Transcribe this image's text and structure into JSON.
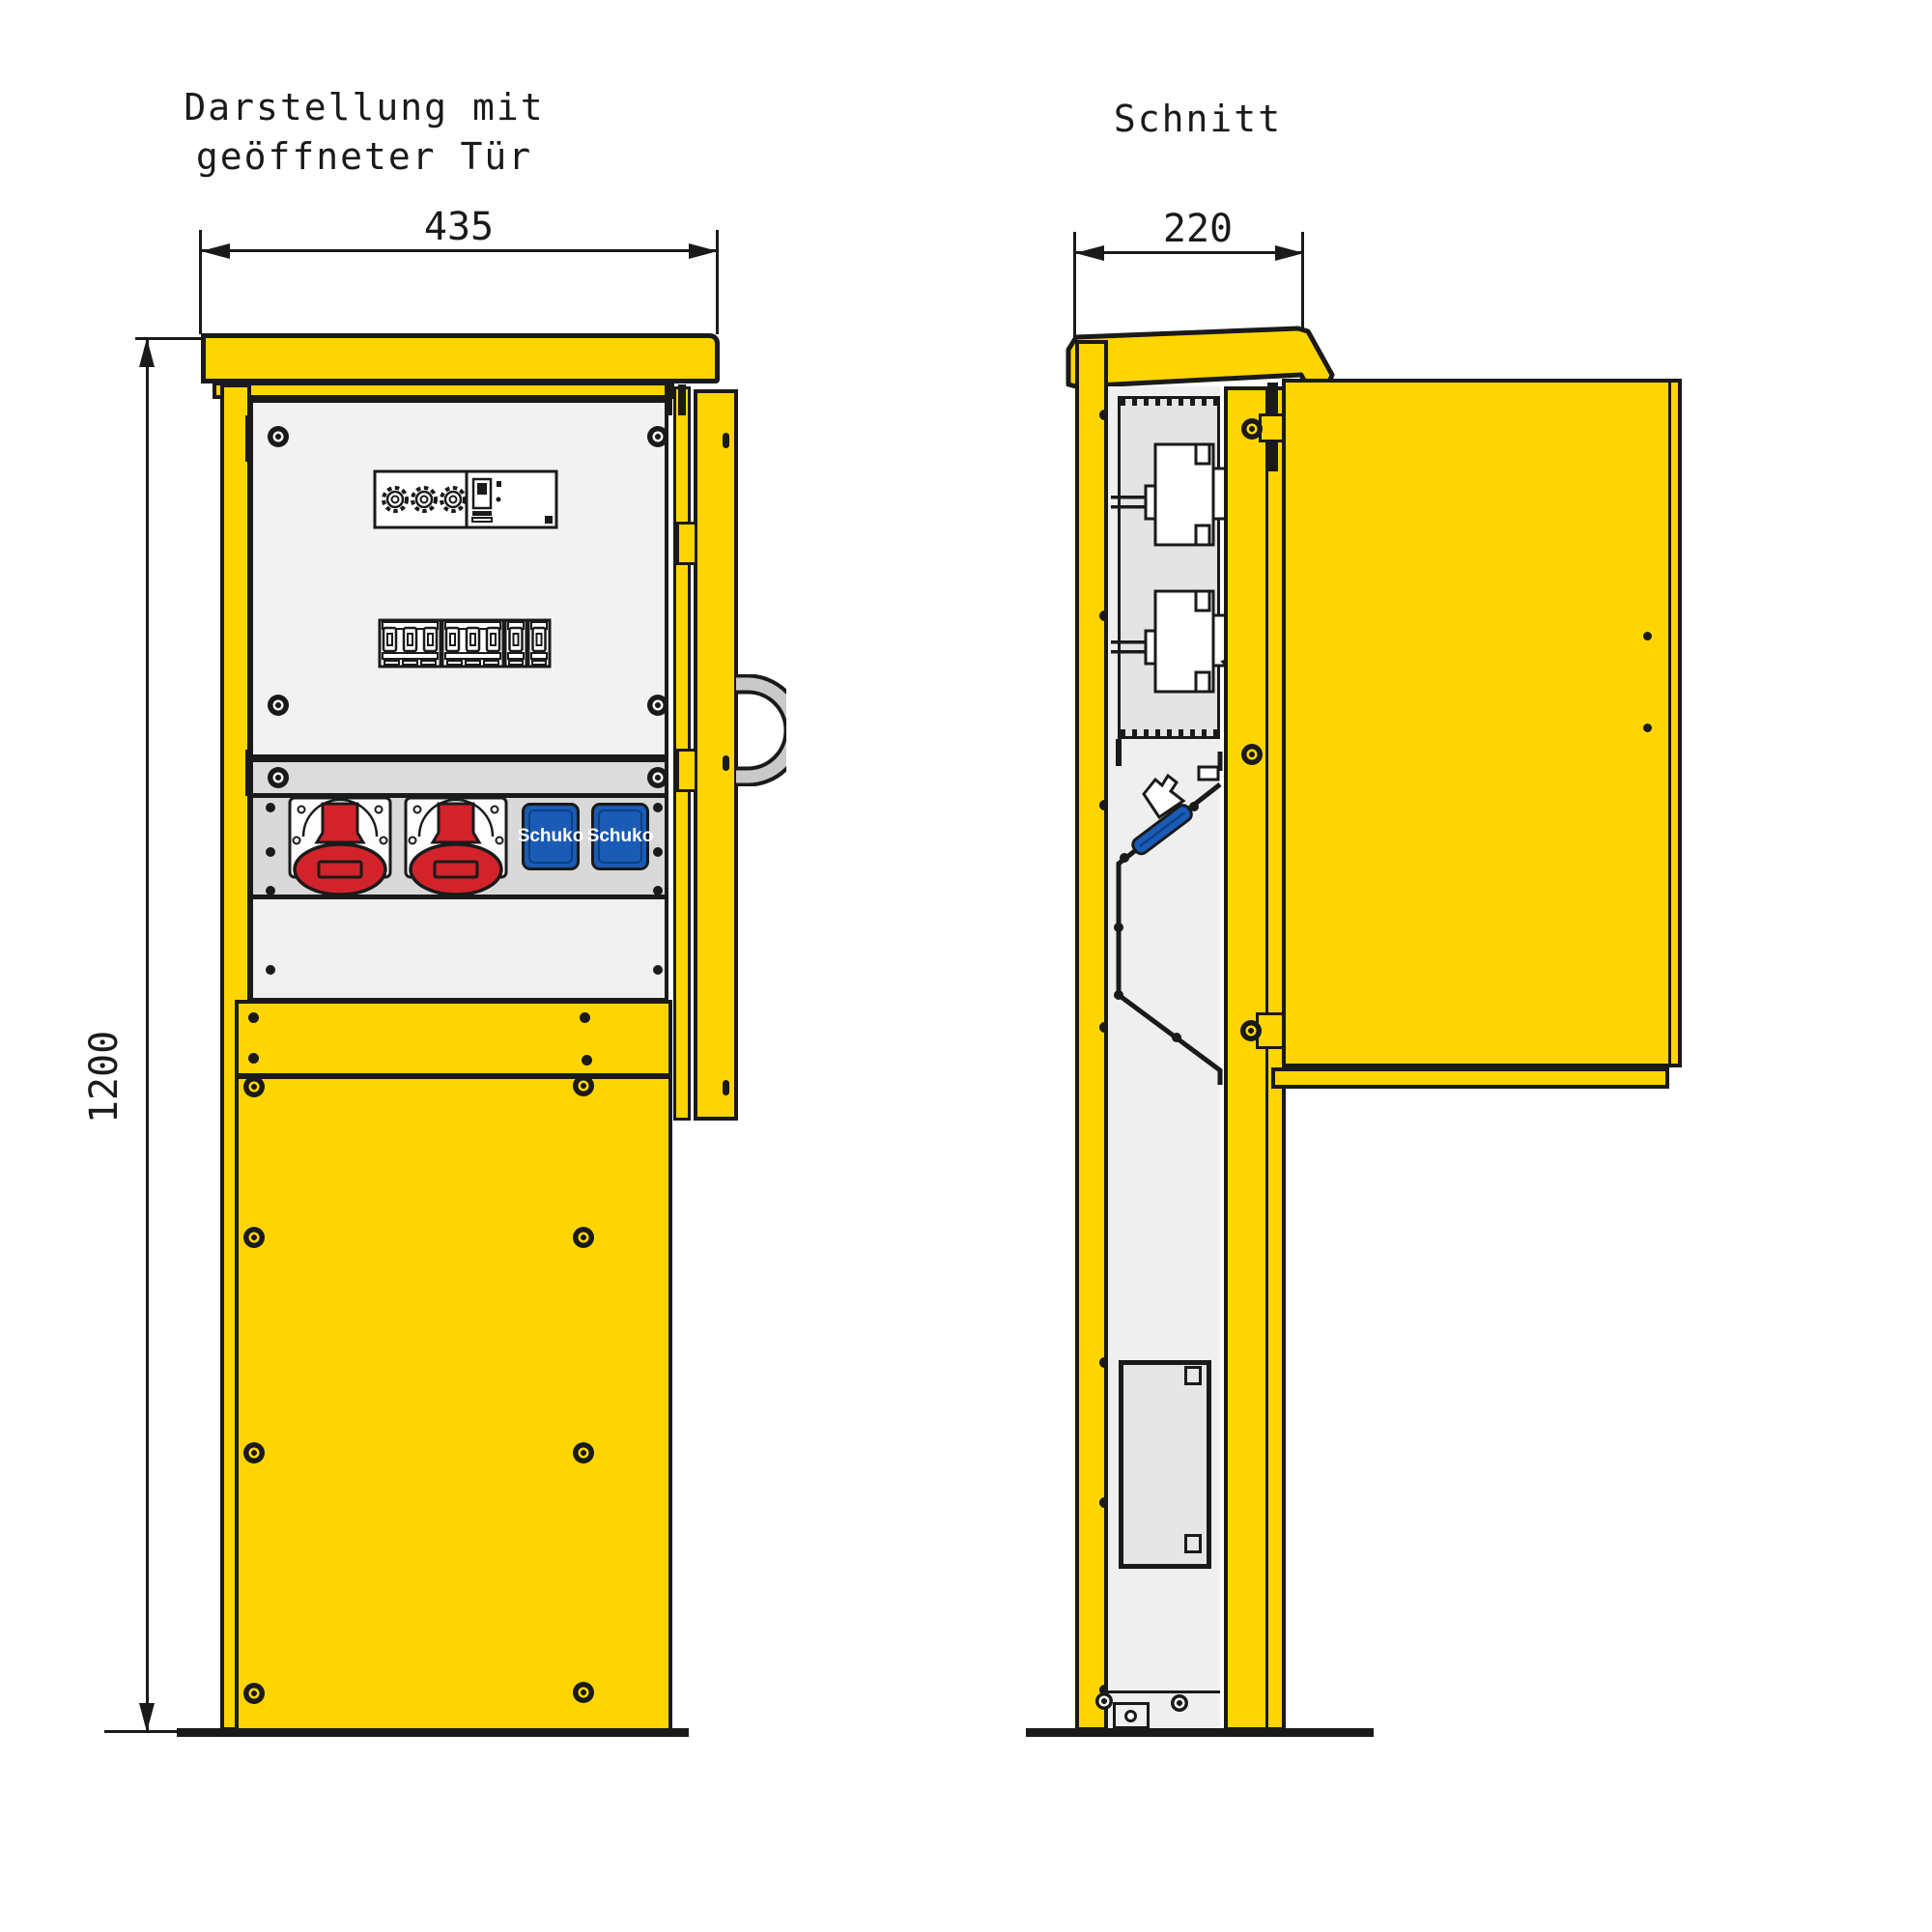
{
  "drawing_type": "technical-drawing-distribution-pillar",
  "left_view": {
    "title_line1": "Darstellung mit",
    "title_line2": "geöffneter Tür",
    "width_dim": "435",
    "height_dim": "1200",
    "schuko_label": "Schuko"
  },
  "right_view": {
    "title": "Schnitt",
    "depth_dim": "220"
  },
  "colors": {
    "cabinet_yellow": "#FFD500",
    "outline_black": "#1A1A1A",
    "panel_light": "#F2F2F2",
    "panel_mid": "#DCDCDC",
    "cee_socket_red": "#D2232A",
    "schuko_blue": "#1A5BB5",
    "handle_grey": "#C9C9C9"
  }
}
